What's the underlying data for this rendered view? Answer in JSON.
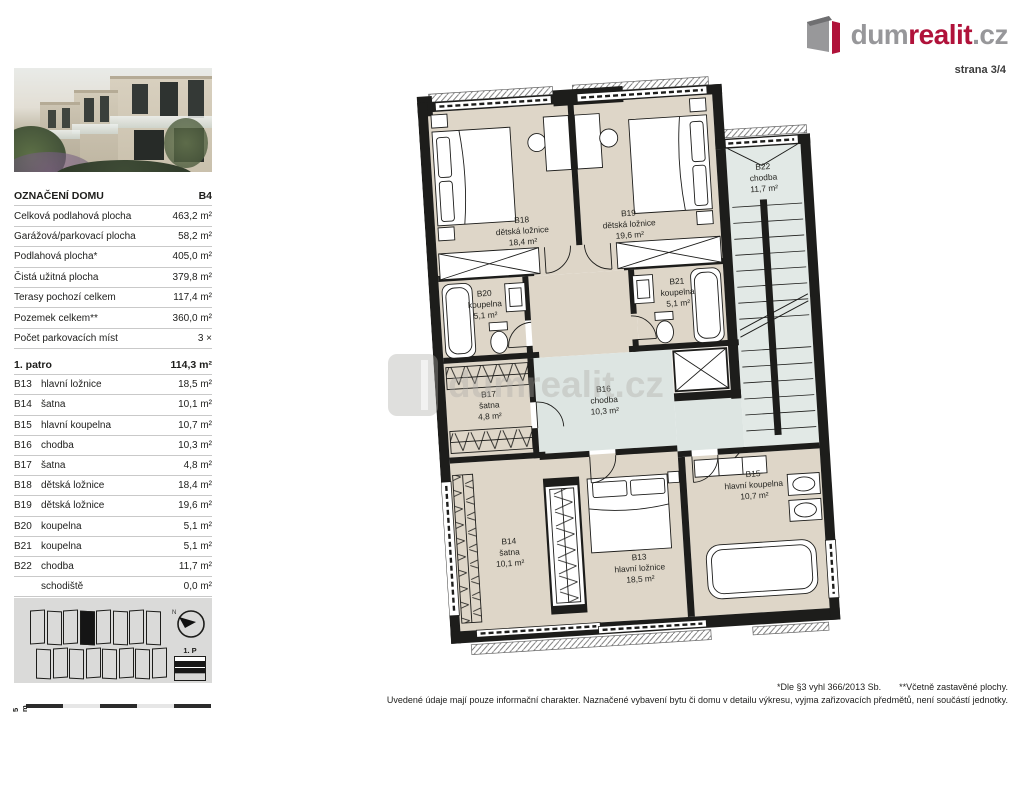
{
  "logo": {
    "gray1": "dum",
    "red": "realit",
    "gray2": ".cz"
  },
  "page_label": "strana 3/4",
  "colors": {
    "brand_red": "#b0123a",
    "wall": "#1d1d1b",
    "room_beige": "#ded6c8",
    "corridor_blue": "#dde5e2",
    "diagram_gray": "#dadad9"
  },
  "sidebar": {
    "house_table": {
      "header_label": "OZNAČENÍ DOMU",
      "header_value": "B4",
      "rows": [
        {
          "label": "Celková podlahová plocha",
          "value": "463,2 m²"
        },
        {
          "label": "Garážová/parkovací plocha",
          "value": "58,2 m²"
        },
        {
          "label": "Podlahová plocha*",
          "value": "405,0 m²"
        },
        {
          "label": "Čistá užitná plocha",
          "value": "379,8 m²"
        },
        {
          "label": "Terasy pochozí celkem",
          "value": "117,4 m²"
        },
        {
          "label": "Pozemek celkem**",
          "value": "360,0 m²"
        },
        {
          "label": "Počet parkovacích míst",
          "value": "3 ×"
        }
      ]
    },
    "floor_table": {
      "header_label": "1. patro",
      "header_value": "114,3 m²",
      "rows": [
        {
          "id": "B13",
          "name": "hlavní ložnice",
          "value": "18,5 m²"
        },
        {
          "id": "B14",
          "name": "šatna",
          "value": "10,1 m²"
        },
        {
          "id": "B15",
          "name": "hlavní koupelna",
          "value": "10,7 m²"
        },
        {
          "id": "B16",
          "name": "chodba",
          "value": "10,3 m²"
        },
        {
          "id": "B17",
          "name": "šatna",
          "value": "4,8 m²"
        },
        {
          "id": "B18",
          "name": "dětská ložnice",
          "value": "18,4 m²"
        },
        {
          "id": "B19",
          "name": "dětská ložnice",
          "value": "19,6 m²"
        },
        {
          "id": "B20",
          "name": "koupelna",
          "value": "5,1 m²"
        },
        {
          "id": "B21",
          "name": "koupelna",
          "value": "5,1 m²"
        },
        {
          "id": "B22",
          "name": "chodba",
          "value": "11,7 m²"
        },
        {
          "id": "",
          "name": "schodiště",
          "value": "0,0 m²"
        }
      ]
    },
    "floor_icon_label": "1. P",
    "scale_label": "5 m"
  },
  "plan": {
    "rooms": [
      {
        "id": "B18",
        "name": "dětská ložnice",
        "area": "18,4 m²"
      },
      {
        "id": "B19",
        "name": "dětská ložnice",
        "area": "19,6 m²"
      },
      {
        "id": "B20",
        "name": "koupelna",
        "area": "5,1 m²"
      },
      {
        "id": "B21",
        "name": "koupelna",
        "area": "5,1 m²"
      },
      {
        "id": "B17",
        "name": "šatna",
        "area": "4,8 m²"
      },
      {
        "id": "B16",
        "name": "chodba",
        "area": "10,3 m²"
      },
      {
        "id": "B22",
        "name": "chodba",
        "area": "11,7 m²"
      },
      {
        "id": "B14",
        "name": "šatna",
        "area": "10,1 m²"
      },
      {
        "id": "B13",
        "name": "hlavní ložnice",
        "area": "18,5 m²"
      },
      {
        "id": "B15",
        "name": "hlavní koupelna",
        "area": "10,7 m²"
      }
    ]
  },
  "watermark": "dumrealit.cz",
  "footer": {
    "note1": "*Dle §3 vyhl 366/2013 Sb.",
    "note2": "**Včetně zastavěné plochy.",
    "disclaimer": "Uvedené údaje mají pouze informační charakter. Naznačené vybavení bytu či domu v detailu výkresu, vyjma zařizovacích předmětů, není součástí jednotky."
  }
}
